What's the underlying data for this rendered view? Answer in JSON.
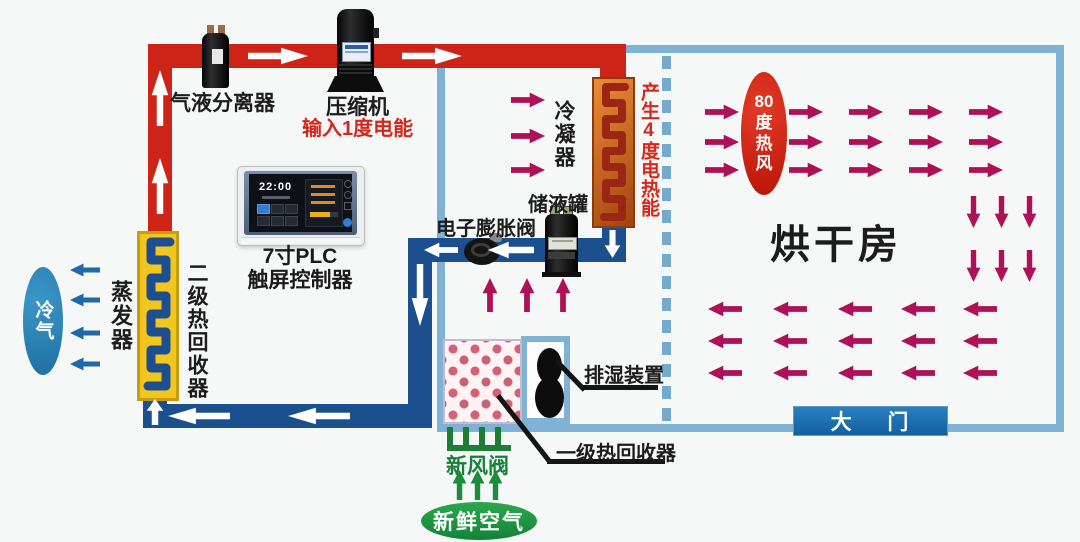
{
  "diagram": {
    "separator_label": "气液分离器",
    "compressor_label": "压缩机",
    "compressor_note": "输入1度电能",
    "condenser_label": "冷凝器",
    "condenser_note": "产生4度电热能",
    "tank_label": "储液罐",
    "valve_label": "电子膨胀阀",
    "plc_label_line1": "7寸PLC",
    "plc_label_line2": "触屏控制器",
    "plc_clock": "22:00",
    "evaporator_label": "蒸发器",
    "heat_recovery2_label": "二级热回收器",
    "cold_air_label": "冷气",
    "drying_room_label": "烘干房",
    "hot_air_label": "80度热风",
    "door_label": "大 门",
    "dehumidifier_label": "排湿装置",
    "heat_recovery1_label": "一级热回收器",
    "fresh_air_valve_label": "新风阀",
    "fresh_air_label": "新鲜空气"
  },
  "colors": {
    "hot_pipe_red": "#ce2418",
    "cold_pipe_blue": "#1c4f8e",
    "air_flow_crimson": "#ae1156",
    "room_border_blue": "#7fb2d4",
    "recovery_box_yellow": "#f2c71d",
    "condenser_box_orange": "#c96a1e",
    "note_text_red": "#d5281c",
    "fresh_air_green": "#1b8c3a",
    "door_blue": "#1a6fb5",
    "cold_air_blue": "#2a82b8"
  }
}
